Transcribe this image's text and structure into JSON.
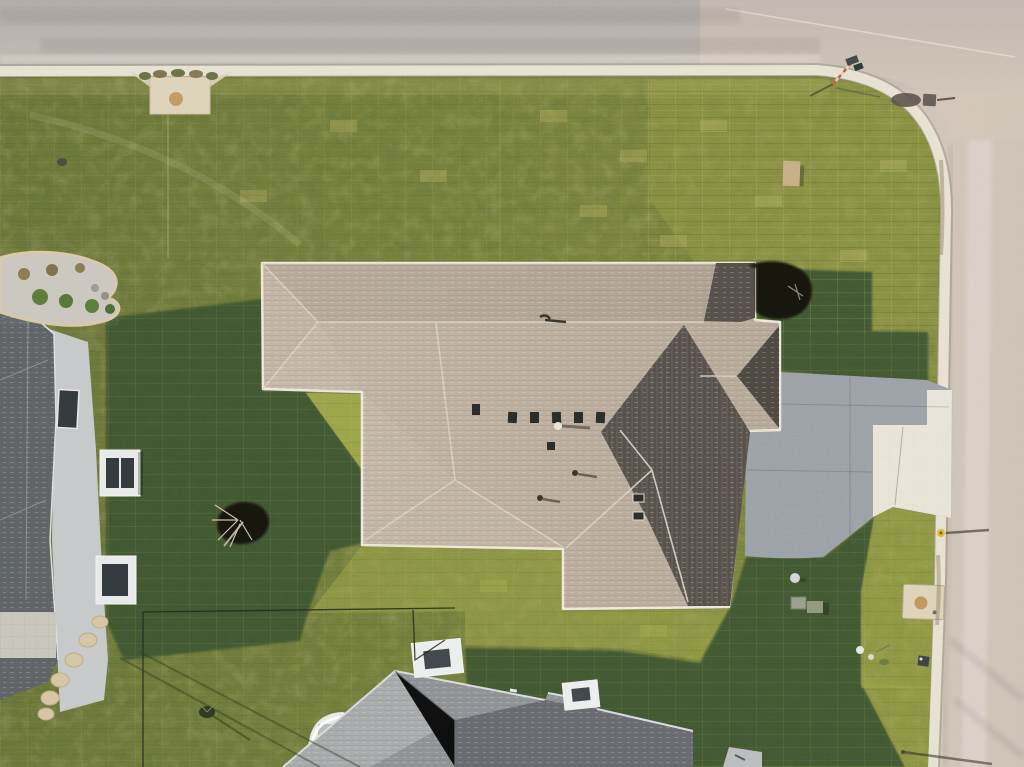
{
  "meta": {
    "kind": "aerial-photograph",
    "width_px": 1024,
    "height_px": 767
  },
  "scene": {
    "description": "Top-down drone photo of a single-family house with a tan hip roof on a corner lot. New sod lawn with visible seams, concrete driveway reaching a street on the right, a second street across the top, neighboring houses at left and bottom, long shadows cast to the east (right).",
    "time_of_day": "late afternoon, low sun from the west",
    "view": "nadir (straight down)"
  },
  "palette": {
    "road_top_far": "#b0aaa8",
    "road_top_near": "#c8c0b4",
    "road_right": "#cdc2b6",
    "road_corner_tint": "#d6c7b8",
    "curb": "#e7e1d2",
    "curb_shade": "#9a937f",
    "lawn_base": "#75803c",
    "lawn_left": "#6b753a",
    "lawn_right": "#828a40",
    "lawn_corner": "#949a48",
    "lawn_bright": "#a2aa4c",
    "shadow_grass": "#3d522e",
    "shadow_fill": "#3e5530",
    "roof_main": "#b7a898",
    "roof_main_light": "#c2b4a4",
    "roof_dark_face": "#57504a",
    "roof_fascia": "#eee8db",
    "ridge_cap": "#d9cfc1",
    "driveway_shade": "#9ba1a6",
    "driveway_lit": "#e9e4d8",
    "left_roof": "#5f6366",
    "left_wall": "#c6c8c9",
    "left_bay": "#e8e9e9",
    "window_dark": "#34393d",
    "bottom_roof": "#8f9295",
    "bottom_roof_light": "#a7a9ab",
    "bottom_roof_dark": "#63666a",
    "chimney_white": "#eceded",
    "rock_bed": "#cbc7bf",
    "bed_edge": "#d9c9a6",
    "shrub_green": "#5d7b3a",
    "mulch_black": "#16130f",
    "flagstone": "#d5c5a2",
    "pad_concrete": "#ded3ba",
    "pad_stain": "#bd8a4e",
    "hydrant_yellow": "#e2b93e",
    "sign_red": "#cc5848",
    "sign_plate": "#3f4b46",
    "object_shadow": "#5b544c",
    "utility_tan": "#c7ae87",
    "ac_box": "#98a08c",
    "patio_pavers": "#c8c5bc"
  },
  "objects": [
    {
      "name": "street-top",
      "desc": "asphalt street across the top with tire wear bands",
      "approx_px": {
        "x": 0,
        "y": 0,
        "w": 1024,
        "h": 70
      }
    },
    {
      "name": "street-right",
      "desc": "asphalt street down the right side, joined by rounded corner",
      "approx_px": {
        "x": 930,
        "y": 60,
        "w": 94,
        "h": 707
      }
    },
    {
      "name": "curb",
      "desc": "white concrete curb/gutter band following both streets with rounded corner",
      "approx_px": {
        "x": 0,
        "y": 66,
        "w": 950,
        "h": 701
      }
    },
    {
      "name": "sidewalk-pad",
      "desc": "small concrete pad with brown stain at top-left lawn edge",
      "approx_px": {
        "x": 128,
        "y": 70,
        "w": 104,
        "h": 45
      }
    },
    {
      "name": "main-house-roof",
      "desc": "large tan hip roof of subject house with shaded east faces, ridge caps and vents",
      "approx_px": {
        "x": 262,
        "y": 262,
        "w": 518,
        "h": 347
      }
    },
    {
      "name": "driveway",
      "desc": "concrete driveway, left portion in house shadow, sunlit apron meeting right street",
      "approx_px": {
        "x": 740,
        "y": 368,
        "w": 212,
        "h": 192
      }
    },
    {
      "name": "left-house",
      "desc": "neighboring house at left edge: dark gray roof, light siding wall, two white window bays",
      "approx_px": {
        "x": 0,
        "y": 300,
        "w": 145,
        "h": 420
      }
    },
    {
      "name": "landscape-rock-bed",
      "desc": "kidney-shaped river-rock bed with shrubs and tan edging",
      "approx_px": {
        "x": 0,
        "y": 250,
        "w": 122,
        "h": 78
      }
    },
    {
      "name": "bottom-house",
      "desc": "neighboring house at bottom: gray roof, white chimney box, white porch",
      "approx_px": {
        "x": 283,
        "y": 640,
        "w": 412,
        "h": 127
      }
    },
    {
      "name": "mulch-bed",
      "desc": "black mulch planting bed at NE corner of main roof",
      "approx_px": {
        "x": 745,
        "y": 262,
        "w": 68,
        "h": 60
      }
    },
    {
      "name": "sapling-tree",
      "desc": "young bare tree in black mulch circle, west lawn",
      "approx_px": {
        "x": 216,
        "y": 500,
        "w": 54,
        "h": 46
      }
    },
    {
      "name": "backyard-fence",
      "desc": "thin wire fence lines with diagonal shadows, lower-left yard",
      "approx_px": {
        "x": 120,
        "y": 605,
        "w": 340,
        "h": 162
      }
    },
    {
      "name": "fire-hydrant",
      "desc": "yellow hydrant by right curb with long eastward shadow",
      "approx_px": {
        "x": 936,
        "y": 528,
        "w": 55,
        "h": 10
      }
    },
    {
      "name": "street-sign",
      "desc": "street-name sign with red/white pole at the corner, shadow cast onto road",
      "approx_px": {
        "x": 808,
        "y": 55,
        "w": 150,
        "h": 55
      }
    },
    {
      "name": "utility-pad",
      "desc": "square concrete utility pad with rust stain near right lot line",
      "approx_px": {
        "x": 903,
        "y": 584,
        "w": 42,
        "h": 36
      }
    },
    {
      "name": "utility-box-tan",
      "desc": "tan utility box in lawn near top-right corner",
      "approx_px": {
        "x": 783,
        "y": 160,
        "w": 18,
        "h": 26
      }
    },
    {
      "name": "ac-units",
      "desc": "two utility/AC boxes behind house near driveway",
      "approx_px": {
        "x": 791,
        "y": 596,
        "w": 34,
        "h": 16
      }
    },
    {
      "name": "flagstone-path",
      "desc": "curved flagstone stepping path from left house to yard",
      "approx_px": {
        "x": 42,
        "y": 615,
        "w": 70,
        "h": 105
      }
    },
    {
      "name": "lawn",
      "desc": "sodded lawn with visible seam grid, lit yellow-green and deep green shadow areas",
      "approx_px": {
        "x": 0,
        "y": 76,
        "w": 945,
        "h": 691
      }
    },
    {
      "name": "cast-shadows",
      "desc": "long building shadows pointing east/right across grass and driveway",
      "approx_px": {
        "x": 106,
        "y": 268,
        "w": 800,
        "h": 499
      }
    }
  ]
}
